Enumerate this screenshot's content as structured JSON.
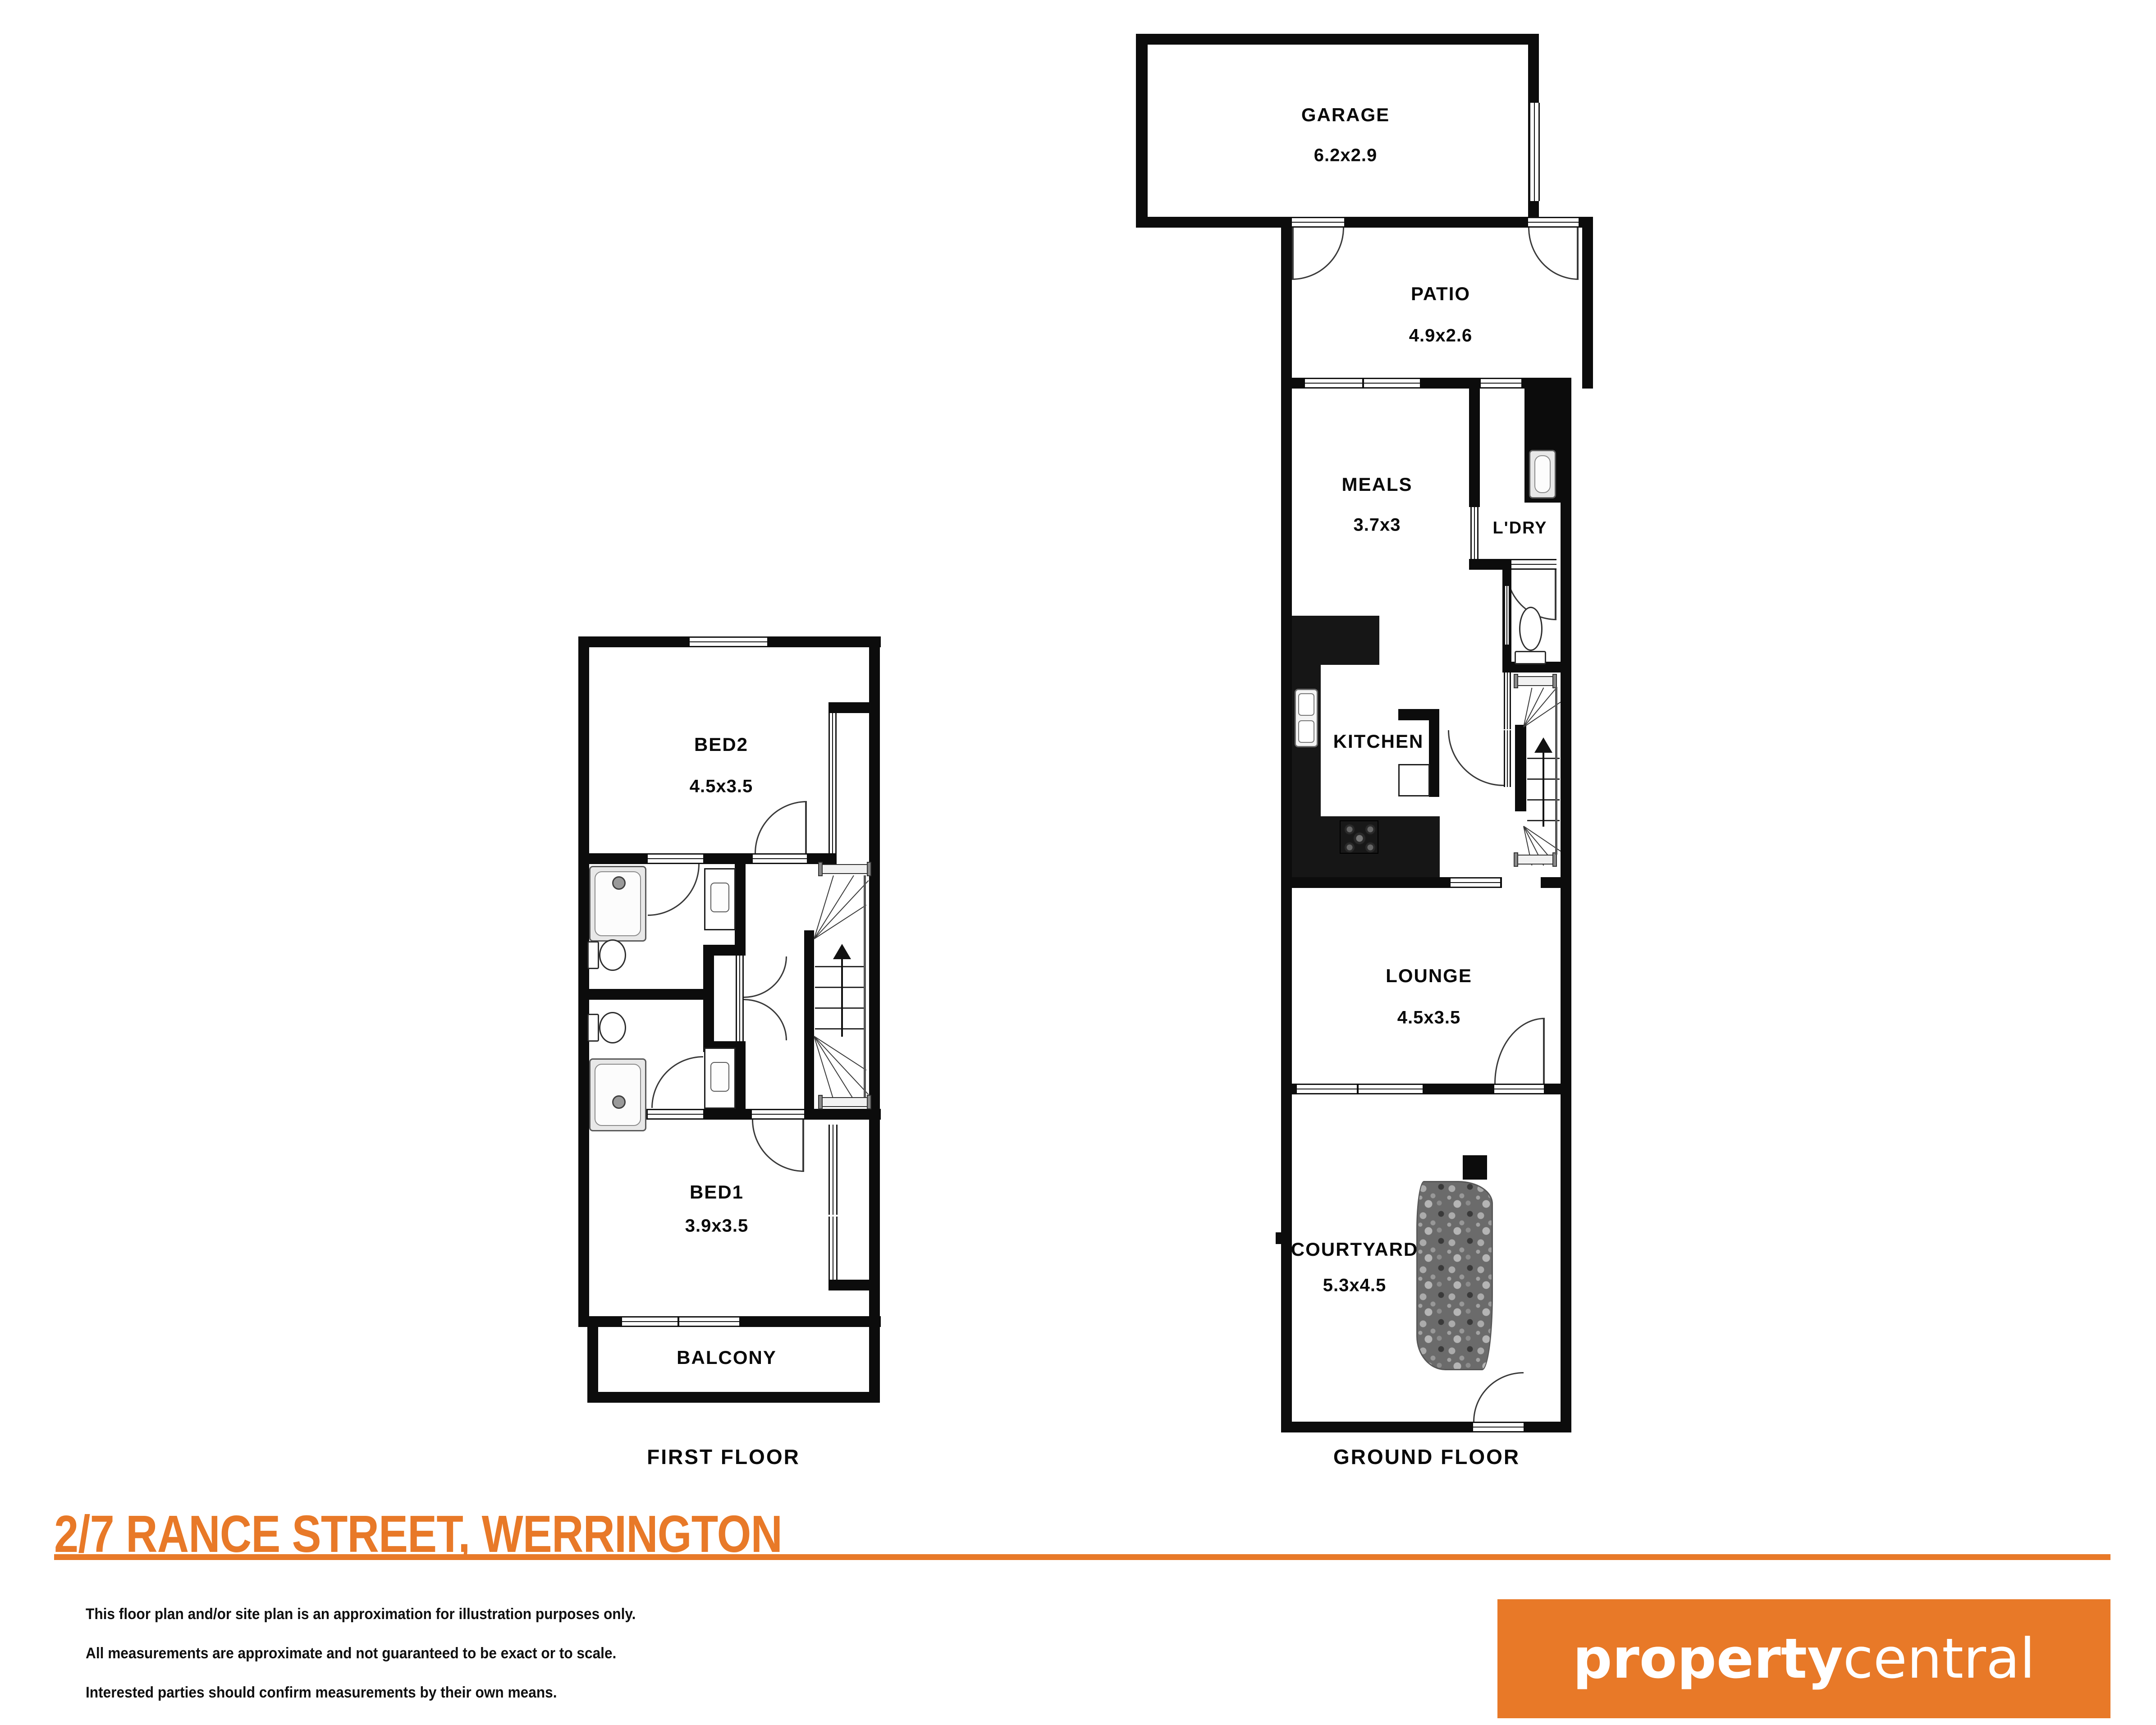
{
  "colors": {
    "accent_orange": "#E87928",
    "wall_black": "#0c0c0c",
    "garden_gray": "#6b6b6b"
  },
  "address": "2/7 RANCE STREET, WERRINGTON",
  "floors": [
    {
      "label": "FIRST FLOOR",
      "rooms": [
        {
          "name": "BED2",
          "dims": "4.5x3.5"
        },
        {
          "name": "BED1",
          "dims": "3.9x3.5"
        },
        {
          "name": "BALCONY",
          "dims": ""
        }
      ]
    },
    {
      "label": "GROUND FLOOR",
      "rooms": [
        {
          "name": "GARAGE",
          "dims": "6.2x2.9"
        },
        {
          "name": "PATIO",
          "dims": "4.9x2.6"
        },
        {
          "name": "MEALS",
          "dims": "3.7x3"
        },
        {
          "name": "L'DRY",
          "dims": ""
        },
        {
          "name": "KITCHEN",
          "dims": ""
        },
        {
          "name": "LOUNGE",
          "dims": "4.5x3.5"
        },
        {
          "name": "COURTYARD",
          "dims": "5.3x4.5"
        }
      ]
    }
  ],
  "disclaimer": [
    "This floor plan and/or site plan is an approximation for illustration purposes only.",
    "All measurements are approximate and not guaranteed to be exact or to scale.",
    "Interested parties should confirm measurements by their own means."
  ],
  "logo": {
    "bold": "property",
    "light": "central"
  }
}
